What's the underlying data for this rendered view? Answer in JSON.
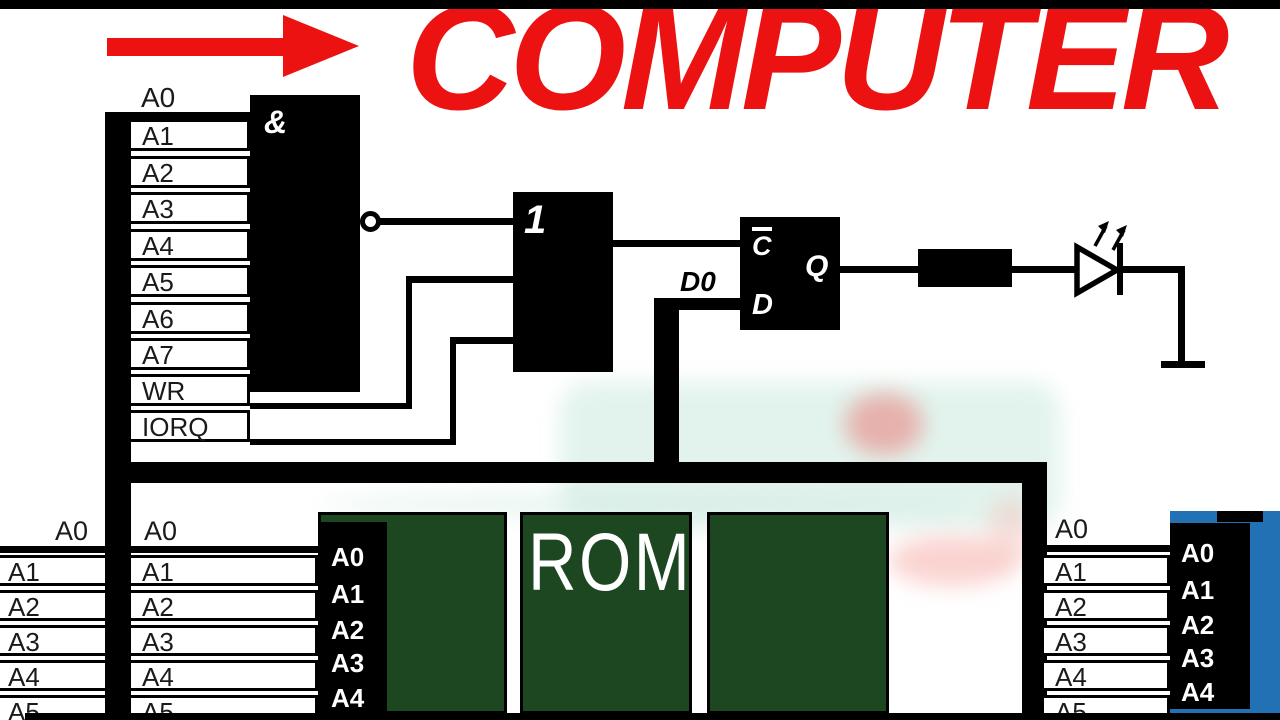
{
  "title": {
    "text": "COMPUTER"
  },
  "colors": {
    "accent_red": "#ec1212",
    "chip_green": "#1d4721",
    "chip_blue": "#2271b5",
    "wire_black": "#000000"
  },
  "cpu_pins": [
    "A0",
    "A1",
    "A2",
    "A3",
    "A4",
    "A5",
    "A6",
    "A7",
    "WR",
    "IORQ"
  ],
  "gates": {
    "and_label": "&",
    "or_label": "1",
    "ff_clock_label": "C",
    "ff_data_label": "D",
    "ff_output_label": "Q",
    "data_bit_label": "D0"
  },
  "rom": {
    "name": "ROM",
    "pins": [
      "A0",
      "A1",
      "A2",
      "A3",
      "A4"
    ]
  },
  "addr_col_left": [
    "A0",
    "A1",
    "A2",
    "A3",
    "A4",
    "A5"
  ],
  "addr_col_mid": [
    "A0",
    "A1",
    "A2",
    "A3",
    "A4",
    "A5"
  ],
  "addr_col_right": [
    "A0",
    "A1",
    "A2",
    "A3",
    "A4",
    "A5"
  ],
  "right_chip": {
    "pins": [
      "A0",
      "A1",
      "A2",
      "A3",
      "A4"
    ]
  }
}
